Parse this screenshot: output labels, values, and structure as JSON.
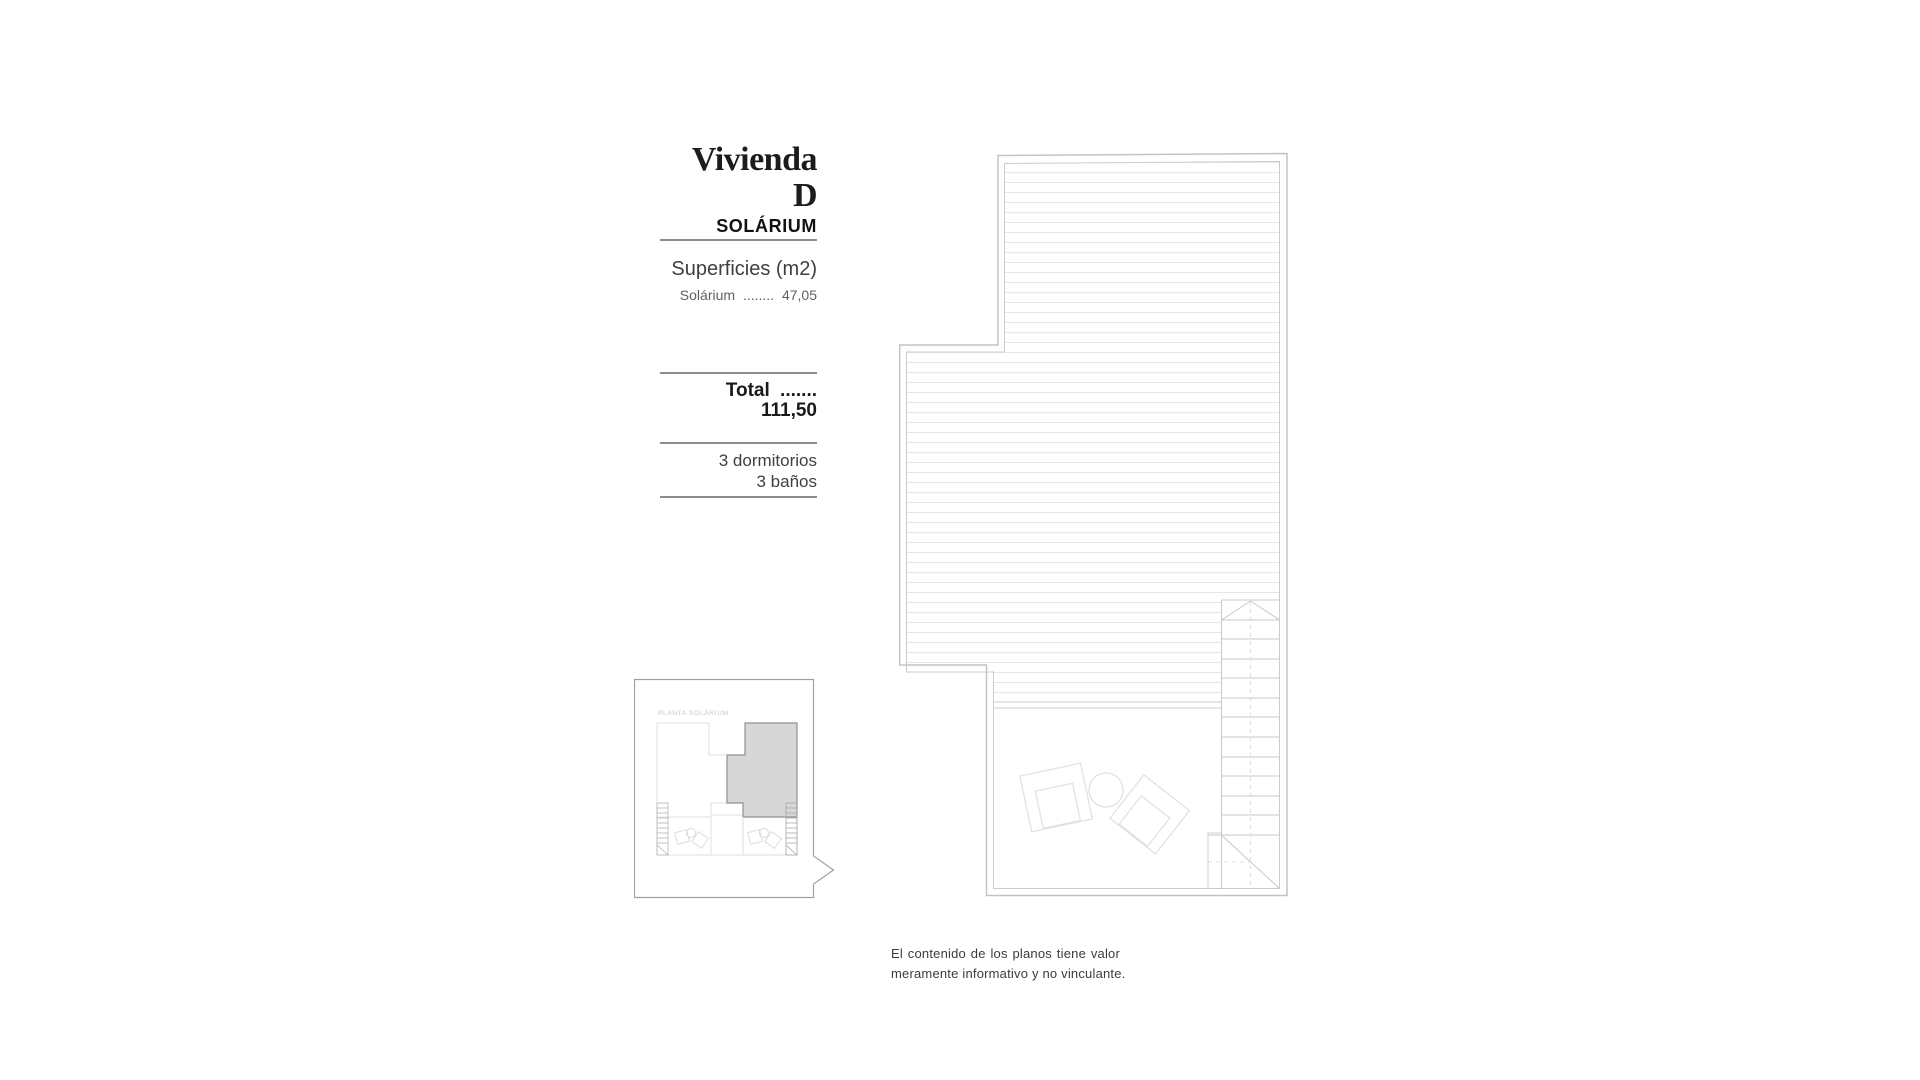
{
  "info_panel": {
    "title": "Vivienda D",
    "subtitle": "SOLÁRIUM",
    "surfaces_heading": "Superficies (m2)",
    "surface_rows": [
      {
        "label": "Solárium",
        "leader": "........",
        "value": "47,05"
      }
    ],
    "total": {
      "label": "Total",
      "leader": ".......",
      "value": "111,50"
    },
    "features": [
      "3 dormitorios",
      "3 baños"
    ]
  },
  "key_plan": {
    "caption": "PLANTA  SOLÁRIUM"
  },
  "disclaimer": {
    "line1": "El contenido de los planos tiene valor",
    "line2": "meramente informativo y no vinculante."
  },
  "colors": {
    "background": "#ffffff",
    "text_primary": "#1c1c1c",
    "text_secondary": "#5f5f5f",
    "rule_gray": "#8c8c8c",
    "plan_wall_outer": "#c3c3c3",
    "plan_wall_inner": "#cccccc",
    "deck_hatch": "#e6e6e6",
    "stair_line": "#c8c8c8",
    "furniture_line": "#e0e0e0",
    "key_plan_border": "#a0a0a0",
    "key_plan_highlight_fill": "#d7d7d7",
    "key_plan_highlight_stroke": "#909090",
    "key_plan_light_line": "#e0e0e0"
  }
}
